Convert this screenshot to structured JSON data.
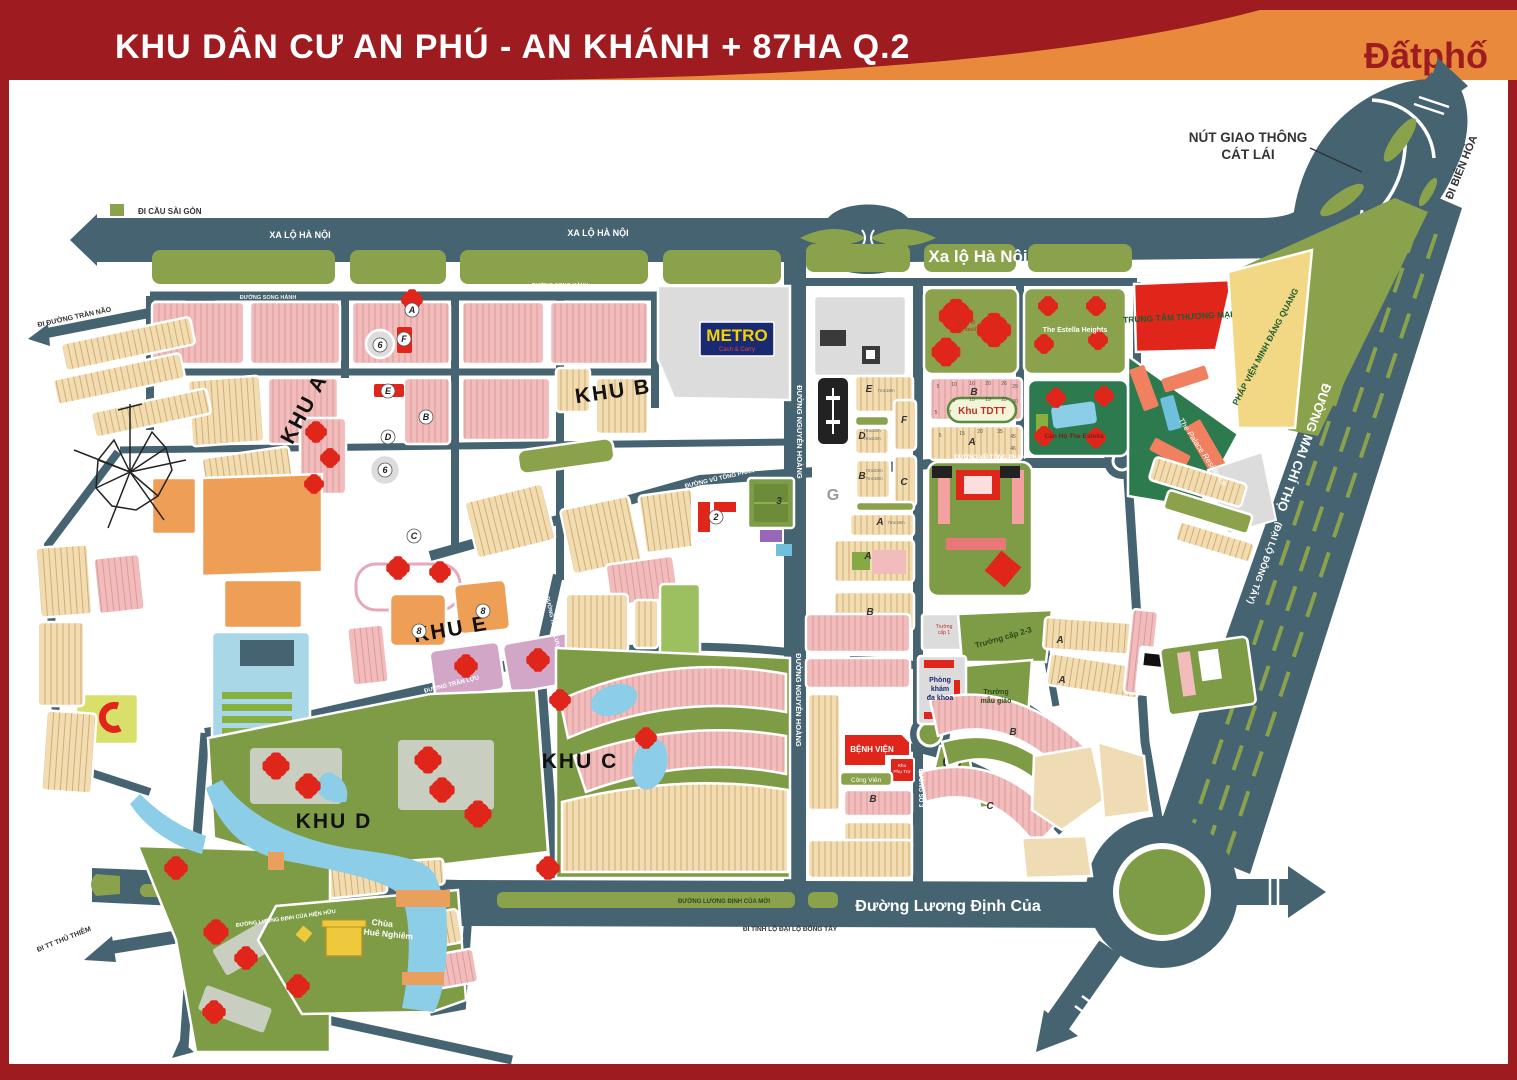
{
  "header": {
    "title": "KHU DÂN CƯ AN PHÚ -  AN KHÁNH + 87HA Q.2",
    "brand": "Đấtphố"
  },
  "palette": {
    "frame_red": "#9E1B20",
    "swoosh_orange": "#E8893C",
    "road_slate": "#456370",
    "median_green": "#8AA24B",
    "park_green": "#7E9C45",
    "estate_green": "#2E7A4F",
    "housing_pink": "#F2BCBC",
    "housing_cream": "#F2DDB2",
    "block_orange": "#EE9E55",
    "landmark_red": "#E0251B",
    "water_blue": "#8CCDE8",
    "temple_yellow": "#EFC93C",
    "metro_navy": "#1A2A72",
    "metro_yellow": "#F2D200"
  },
  "zones": {
    "khu_a": "KHU A",
    "khu_b": "KHU B",
    "khu_c": "KHU C",
    "khu_d": "KHU D",
    "khu_e": "KHU E"
  },
  "roads": {
    "di_cau_sai_gon": "ĐI CẦU SÀI GÒN",
    "xa_lo_ha_noi_1": "XA LỘ HÀ NỘI",
    "xa_lo_ha_noi_2": "XA LỘ HÀ NỘI",
    "xa_lo_ha_noi_big": "Xa lộ Hà Nội",
    "song_hanh_1": "ĐƯỜNG SONG HÀNH",
    "song_hanh_2": "ĐƯỜNG SONG HÀNH",
    "di_duong_tran_nao": "ĐI ĐƯỜNG TRẦN NÃO",
    "nguyen_hoang_1": "ĐƯỜNG NGUYỄN HOÀNG",
    "nguyen_hoang_2": "ĐƯỜNG NGUYỄN HOÀNG",
    "vu_tong_phan_1": "ĐƯỜNG VŨ TÔNG PHAN",
    "vu_tong_phan_2": "ĐƯỜNG VŨ TÔNG PHAN",
    "tran_luu_1": "ĐƯỜNG TRẦN LỰU",
    "tran_luu_2": "ĐƯỜNG TRẦN LỰU",
    "duong_so_3": "ĐƯỜNG SỐ 3",
    "mai_chi_tho": "ĐƯỜNG MAI CHÍ THỌ",
    "dai_lo_dong_tay": "(ĐẠI LỘ ĐÔNG TÂY)",
    "di_bien_hoa": "ĐI BIÊN HÒA",
    "nut_giao_1": "NÚT GIAO THÔNG",
    "nut_giao_2": "CÁT LÁI",
    "luong_dinh_cua_big": "Đường Lương Định Của",
    "luong_dinh_cua_moi": "ĐƯỜNG LƯƠNG ĐỊNH CỦA MỚI",
    "luong_dinh_cua_hien_huu": "ĐƯỜNG LƯƠNG ĐỊNH CỦA HIỆN HỮU",
    "di_tinh_lo": "ĐI TỈNH LỘ ĐẠI LỘ ĐÔNG TÂY",
    "di_tt_thu_thiem": "ĐI TT THỦ THIÊM"
  },
  "places": {
    "metro": "METRO",
    "metro_sub": "Cash & Carry",
    "khu_tdtt": "Khu TDTT",
    "tttm": "TRUNG TÂM THƯƠNG MẠI",
    "phap_vien": "PHÁP VIỆN MINH ĐĂNG QUANG",
    "palace": "The Palace Residence",
    "estella_heights": "The Estella Heights",
    "can_ho_estella": "Căn Hộ The Estella",
    "cantavil_1": "Căn Hộ",
    "cantavil_2": "Cantavil",
    "benh_vien": "BỆNH VIỆN",
    "khu_phu_tro_1": "Khu",
    "khu_phu_tro_2": "Phụ Trợ",
    "cong_vien": "Công Viên",
    "chua_1": "Chùa",
    "chua_2": "Huê Nghiêm",
    "truong_cap_23": "Trường cấp 2-3",
    "truong_mau_giao_1": "Trường",
    "truong_mau_giao_2": "mẫu giáo",
    "phong_kham_1": "Phòng",
    "phong_kham_2": "khám",
    "phong_kham_3": "đa khoa",
    "truong_cap_1a": "Trường",
    "truong_cap_1b": "cấp 1"
  },
  "markers": [
    {
      "label": "A",
      "x": 412,
      "y": 310,
      "kind": "circled"
    },
    {
      "label": "F",
      "x": 404,
      "y": 339,
      "kind": "circled"
    },
    {
      "label": "6",
      "x": 380,
      "y": 345,
      "kind": "circled"
    },
    {
      "label": "E",
      "x": 388,
      "y": 391,
      "kind": "circled"
    },
    {
      "label": "B",
      "x": 426,
      "y": 417,
      "kind": "circled"
    },
    {
      "label": "D",
      "x": 388,
      "y": 437,
      "kind": "circled"
    },
    {
      "label": "6",
      "x": 385,
      "y": 470,
      "kind": "circled"
    },
    {
      "label": "C",
      "x": 414,
      "y": 536,
      "kind": "circled"
    },
    {
      "label": "8",
      "x": 419,
      "y": 631,
      "kind": "circled"
    },
    {
      "label": "8",
      "x": 483,
      "y": 611,
      "kind": "circled"
    },
    {
      "label": "2",
      "x": 716,
      "y": 517,
      "kind": "circled"
    },
    {
      "label": "3",
      "x": 779,
      "y": 501,
      "kind": "plain"
    },
    {
      "label": "G",
      "x": 833,
      "y": 495,
      "kind": "big"
    },
    {
      "label": "E",
      "x": 869,
      "y": 389,
      "kind": "plain"
    },
    {
      "label": "F",
      "x": 904,
      "y": 420,
      "kind": "plain"
    },
    {
      "label": "D",
      "x": 862,
      "y": 436,
      "kind": "plain"
    },
    {
      "label": "C",
      "x": 904,
      "y": 482,
      "kind": "plain"
    },
    {
      "label": "B",
      "x": 862,
      "y": 476,
      "kind": "plain"
    },
    {
      "label": "A",
      "x": 880,
      "y": 522,
      "kind": "plain"
    },
    {
      "label": "A",
      "x": 868,
      "y": 556,
      "kind": "plain"
    },
    {
      "label": "B",
      "x": 870,
      "y": 612,
      "kind": "plain"
    },
    {
      "label": "B",
      "x": 974,
      "y": 392,
      "kind": "plain"
    },
    {
      "label": "A",
      "x": 972,
      "y": 442,
      "kind": "plain"
    },
    {
      "label": "A",
      "x": 1060,
      "y": 640,
      "kind": "plain"
    },
    {
      "label": "A",
      "x": 1062,
      "y": 680,
      "kind": "plain"
    },
    {
      "label": "B",
      "x": 1013,
      "y": 732,
      "kind": "plain"
    },
    {
      "label": "C",
      "x": 990,
      "y": 806,
      "kind": "plain"
    },
    {
      "label": "B",
      "x": 873,
      "y": 799,
      "kind": "plain"
    }
  ],
  "lot_numbers": [
    {
      "t": "5",
      "x": 938,
      "y": 388
    },
    {
      "t": "10",
      "x": 954,
      "y": 386
    },
    {
      "t": "16",
      "x": 972,
      "y": 385
    },
    {
      "t": "20",
      "x": 988,
      "y": 385
    },
    {
      "t": "26",
      "x": 1004,
      "y": 385
    },
    {
      "t": "29",
      "x": 1015,
      "y": 388
    },
    {
      "t": "9",
      "x": 954,
      "y": 402
    },
    {
      "t": "15",
      "x": 972,
      "y": 401
    },
    {
      "t": "19",
      "x": 988,
      "y": 401
    },
    {
      "t": "25",
      "x": 1004,
      "y": 401
    },
    {
      "t": "30",
      "x": 1015,
      "y": 403
    },
    {
      "t": "5",
      "x": 936,
      "y": 414
    },
    {
      "t": "7",
      "x": 950,
      "y": 414
    },
    {
      "t": "5",
      "x": 940,
      "y": 437
    },
    {
      "t": "15",
      "x": 962,
      "y": 435
    },
    {
      "t": "20",
      "x": 980,
      "y": 433
    },
    {
      "t": "35",
      "x": 1000,
      "y": 433
    },
    {
      "t": "45",
      "x": 1013,
      "y": 438
    },
    {
      "t": "46",
      "x": 1013,
      "y": 450
    }
  ],
  "lot_sizes": [
    {
      "t": "7mx18m",
      "x": 886,
      "y": 392
    },
    {
      "t": "7mx18m",
      "x": 872,
      "y": 432
    },
    {
      "t": "7mx23m",
      "x": 872,
      "y": 440
    },
    {
      "t": "7mx23m",
      "x": 874,
      "y": 472
    },
    {
      "t": "7mx18m",
      "x": 874,
      "y": 480
    },
    {
      "t": "7mx18m",
      "x": 896,
      "y": 524
    }
  ]
}
